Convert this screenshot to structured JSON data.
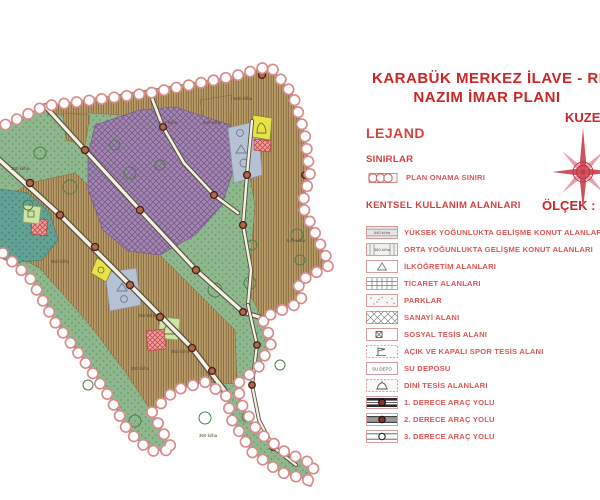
{
  "header": {
    "title_line1": "KARABÜK MERKEZ İLAVE - REV",
    "title_line2": "NAZIM İMAR PLANI",
    "north_label": "KUZE",
    "scale_label": "ÖLÇEK : 1"
  },
  "legend": {
    "title": "LEJAND",
    "sections": [
      {
        "heading": "SINIRLAR",
        "items": [
          {
            "symbol": "plan-boundary-circles",
            "label": "PLAN ONAMA SINIRI"
          }
        ]
      },
      {
        "heading": "KENTSEL KULLANIM ALANLARI",
        "items": [
          {
            "symbol": "horizontal-hatch-swatch",
            "symbol_text": "640 ki/ha",
            "label": "YÜKSEK YOĞUNLUKTA GELİŞME KONUT ALANLARI"
          },
          {
            "symbol": "vertical-hatch-swatch",
            "symbol_text": "360 ki/ha",
            "label": "ORTA YOĞUNLUKTA GELİŞME KONUT ALANLARI"
          },
          {
            "symbol": "triangle-swatch",
            "label": "İLKÖĞRETİM ALANLARI"
          },
          {
            "symbol": "grid-swatch",
            "label": "TİCARET ALANLARI"
          },
          {
            "symbol": "dots-swatch",
            "label": "PARKLAR"
          },
          {
            "symbol": "diamond-hatch-swatch",
            "label": "SANAYİ ALANI"
          },
          {
            "symbol": "square-x-swatch",
            "label": "SOSYAL TESİS ALANI"
          },
          {
            "symbol": "flag-swatch",
            "label": "AÇIK VE KAPALI SPOR TESİS ALANI"
          },
          {
            "symbol": "text-swatch",
            "symbol_text": "SU DEPO",
            "label": "SU DEPOSU"
          },
          {
            "symbol": "dome-swatch",
            "label": "DİNİ TESİS ALANLARI"
          },
          {
            "symbol": "road-primary-swatch",
            "label": "1. DERECE ARAÇ YOLU"
          },
          {
            "symbol": "road-secondary-swatch",
            "label": "2. DERECE ARAÇ YOLU"
          },
          {
            "symbol": "road-tertiary-swatch",
            "label": "3. DERECE ARAÇ YOLU"
          }
        ]
      }
    ]
  },
  "map": {
    "density_labels": [
      {
        "text": "613 ki/ha",
        "x": 168,
        "y": 69
      },
      {
        "text": "540 ki/ha",
        "x": 212,
        "y": 69
      },
      {
        "text": "640 ki/ha",
        "x": 243,
        "y": 45
      },
      {
        "text": "640 ki/ha",
        "x": 296,
        "y": 187
      },
      {
        "text": "360 ki/ha",
        "x": 20,
        "y": 115
      },
      {
        "text": "360 ki/ha",
        "x": 60,
        "y": 208
      },
      {
        "text": "360 ki/ha",
        "x": 147,
        "y": 262
      },
      {
        "text": "360 ki/ha",
        "x": 180,
        "y": 298
      },
      {
        "text": "360 ki/ha",
        "x": 140,
        "y": 315
      },
      {
        "text": "360 ki/ha",
        "x": 208,
        "y": 382
      }
    ],
    "colors": {
      "park_green": "#8FB78D",
      "residential_brown": "#B89C68",
      "industrial_purple": "#A287B0",
      "sports_teal": "#62A193",
      "school_blue": "#B6C1D4",
      "water_tank_yellow": "#E8E24A",
      "religious_red": "#CC5555",
      "boundary_pink": "#D98C8C",
      "accent_red": "#CC2626",
      "legend_text_red": "#E05555"
    }
  }
}
